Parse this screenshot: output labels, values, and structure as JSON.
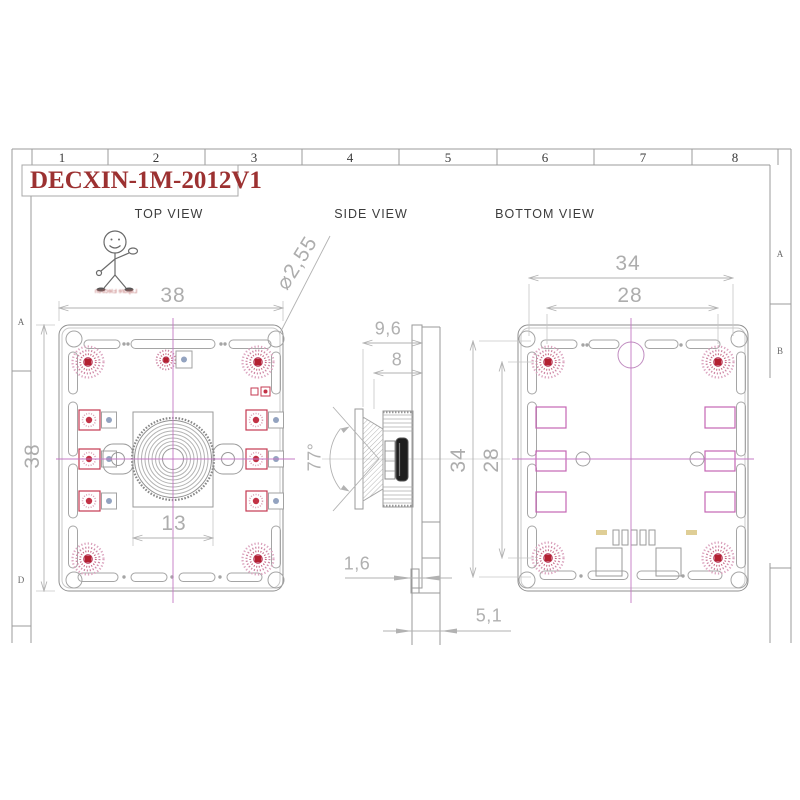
{
  "sheet": {
    "title": "DECXIN-1M-2012V1",
    "ruler_columns": [
      "1",
      "2",
      "3",
      "4",
      "5",
      "6",
      "7",
      "8"
    ],
    "left_margin_rows": [
      "A",
      "D"
    ],
    "right_margin_rows": [
      "A",
      "B"
    ]
  },
  "views": {
    "top": {
      "label": "TOP VIEW",
      "dims": {
        "board_width": "38",
        "board_height": "38",
        "lens_mount_width": "13",
        "mount_hole_diameter": "⌀2,55"
      }
    },
    "side": {
      "label": "SIDE VIEW",
      "dims": {
        "total_depth": "9,6",
        "lens_depth": "8",
        "field_of_view": "77°",
        "pcb_thickness": "1,6",
        "connector_depth": "5,1"
      }
    },
    "bottom": {
      "label": "BOTTOM VIEW",
      "dims": {
        "outer_hole_spacing_h": "34",
        "inner_hole_spacing_h": "28",
        "outer_hole_spacing_v": "34",
        "inner_hole_spacing_v": "28"
      }
    }
  },
  "watermark": {
    "caption": "Lapure Electron"
  },
  "colors": {
    "title_red": "#9c3131",
    "centerline_magenta": "#c478c4",
    "pad_red": "#b32030",
    "dimension_gray": "#b2b2b2"
  }
}
